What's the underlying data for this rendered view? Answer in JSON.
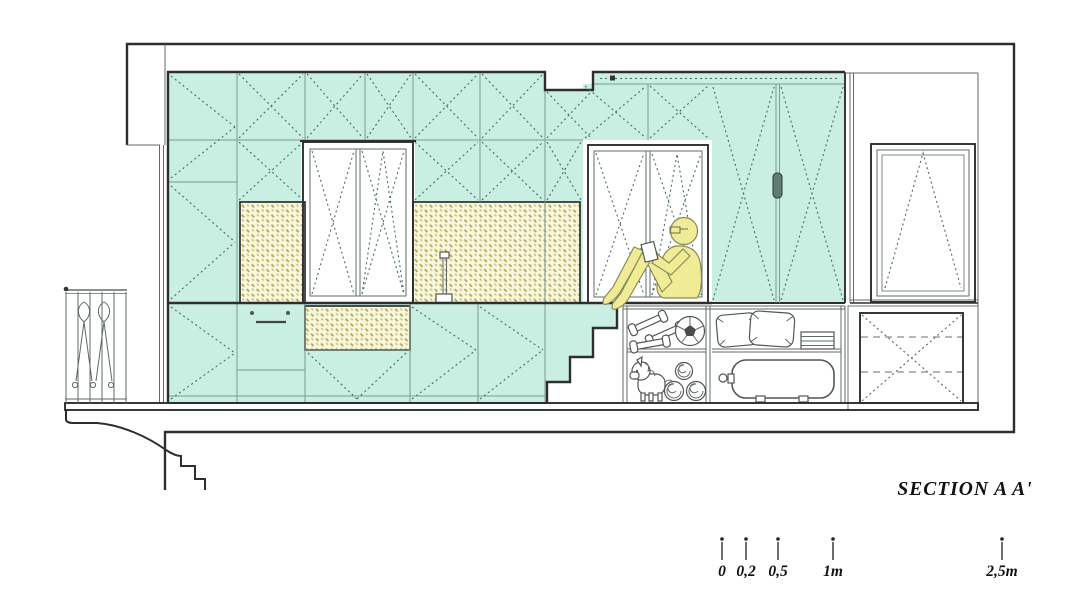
{
  "title": {
    "label": "SECTION A A'"
  },
  "scale_bar": {
    "ticks": [
      {
        "label": "0"
      },
      {
        "label": "0,2"
      },
      {
        "label": "0,5"
      },
      {
        "label": "1m"
      },
      {
        "label": "2,5m"
      }
    ]
  },
  "colors": {
    "cabinet_teal": "#c8efe2",
    "hatch_cream": "#faf7dc",
    "hatch_olive": "#b4ae58",
    "hatch_sage": "#b9c29a",
    "figure_yellow": "#f0eb95",
    "outline": "#2e2e2e"
  },
  "icons": {
    "balcony_railing": "wrought-iron-railing-icon",
    "balcony_cornice": "molded-cornice-icon",
    "wardrobe_doors": "dashed-x-cabinet-door-icon",
    "kitchen_backsplash": "woven-hatch-tile-icon",
    "kitchen_faucet": "faucet-icon",
    "appliance_front": "dishwasher-front-icon",
    "left_window": "double-casement-window-icon",
    "niche_window": "double-casement-window-icon",
    "right_window": "tilt-window-icon",
    "sliding_door": "double-leaf-wardrobe-door-icon",
    "door_handle": "door-handle-icon",
    "door_track": "sliding-track-icon",
    "stairs": "storage-stairs-icon",
    "reading_figure": "person-sitting-reading-icon",
    "shelf_dumbbells": "dumbbells-icon",
    "shelf_football": "soccer-ball-icon",
    "shelf_pillows": "pillows-icon",
    "shelf_linen": "folded-linen-stack-icon",
    "shelf_unicorn": "unicorn-plush-icon",
    "shelf_rolls": "rolled-mats-icon",
    "water_tank": "water-heater-tank-icon",
    "dashed_box": "appliance-dashed-outline-icon"
  }
}
